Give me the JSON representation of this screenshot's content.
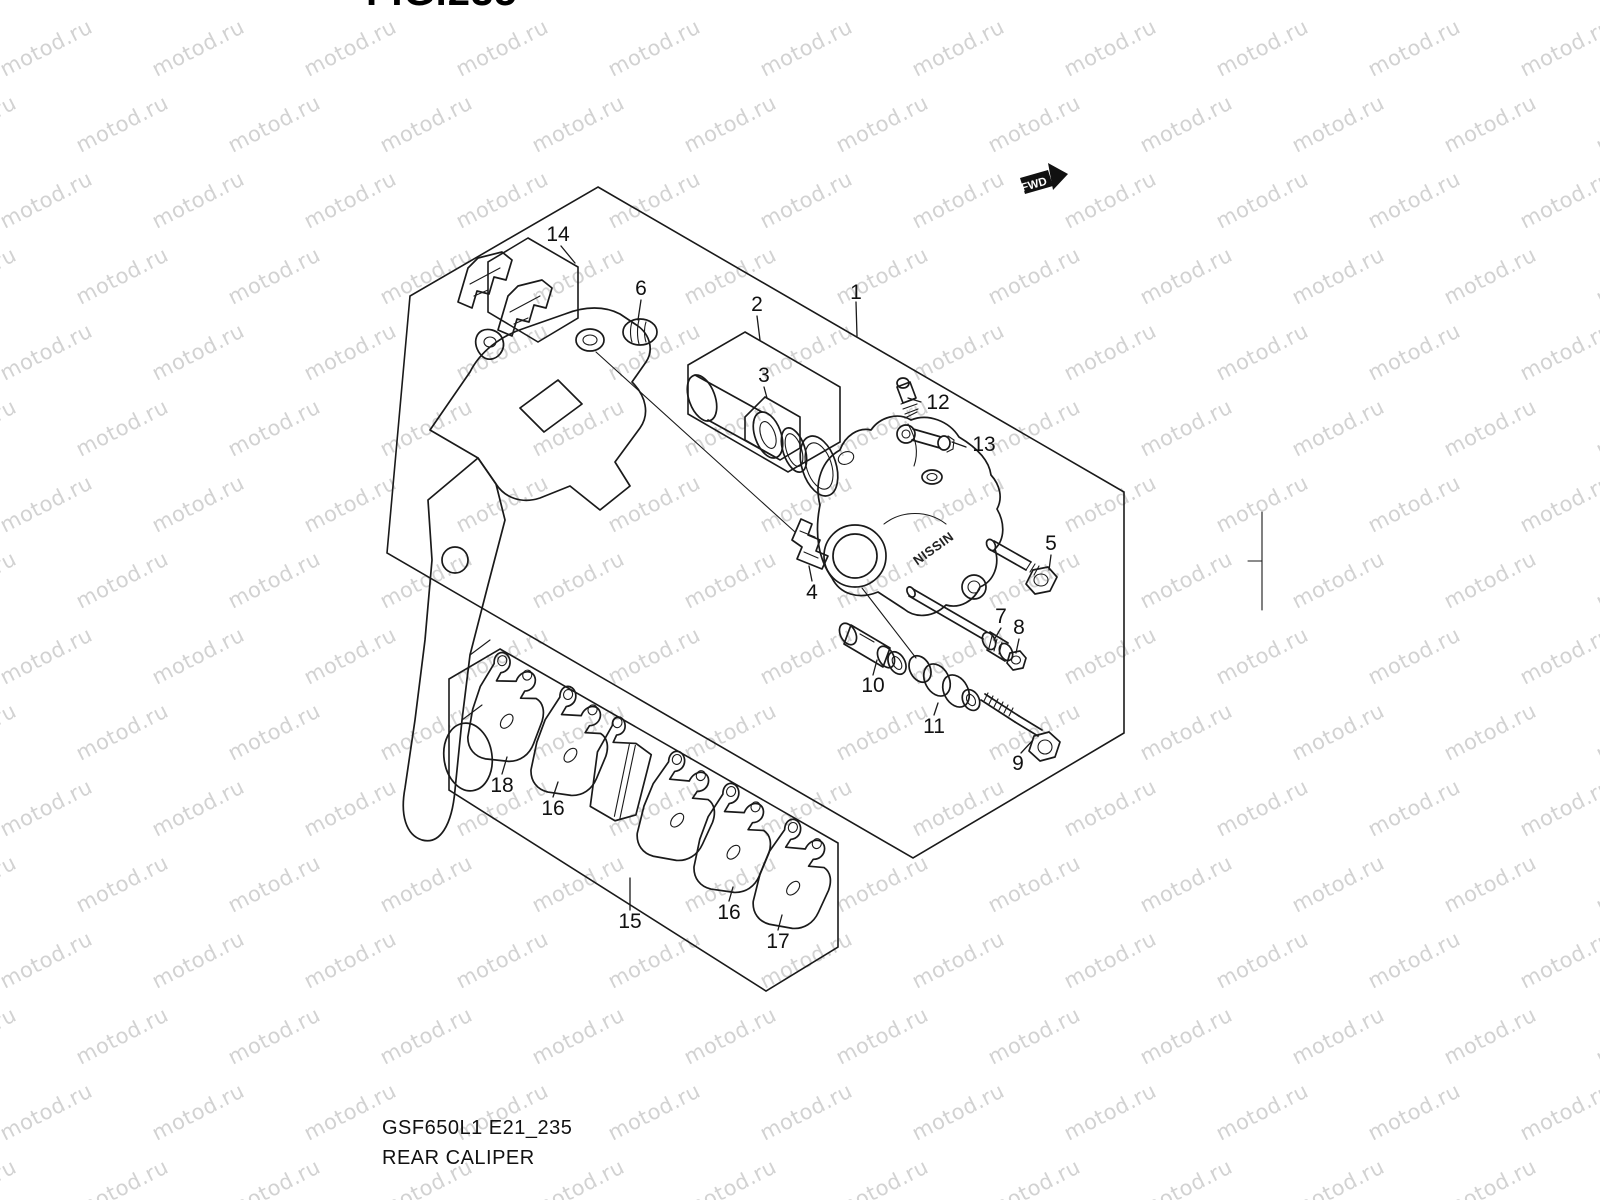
{
  "header": {
    "figure_title": "FIG.235"
  },
  "footer": {
    "model_code": "GSF650L1 E21_235",
    "figure_name": "REAR CALIPER"
  },
  "watermark": {
    "text": "motod.ru",
    "color": "#d2d2d2"
  },
  "direction_marker": {
    "label": "FWD",
    "color": "#111111"
  },
  "caliper_brand": {
    "text": "NISSIN"
  },
  "diagram": {
    "type": "exploded-parts-diagram",
    "subject": "rear brake caliper assembly",
    "line_color": "#1a1a1a",
    "callouts": [
      {
        "id": "callout-1",
        "text": "1"
      },
      {
        "id": "callout-2",
        "text": "2"
      },
      {
        "id": "callout-3",
        "text": "3"
      },
      {
        "id": "callout-4",
        "text": "4"
      },
      {
        "id": "callout-5",
        "text": "5"
      },
      {
        "id": "callout-6",
        "text": "6"
      },
      {
        "id": "callout-7",
        "text": "7"
      },
      {
        "id": "callout-8",
        "text": "8"
      },
      {
        "id": "callout-9",
        "text": "9"
      },
      {
        "id": "callout-10",
        "text": "10"
      },
      {
        "id": "callout-11",
        "text": "11"
      },
      {
        "id": "callout-12",
        "text": "12"
      },
      {
        "id": "callout-13",
        "text": "13"
      },
      {
        "id": "callout-14",
        "text": "14"
      },
      {
        "id": "callout-15",
        "text": "15"
      },
      {
        "id": "callout-16a",
        "text": "16"
      },
      {
        "id": "callout-16b",
        "text": "16"
      },
      {
        "id": "callout-17",
        "text": "17"
      },
      {
        "id": "callout-18",
        "text": "18"
      }
    ]
  }
}
